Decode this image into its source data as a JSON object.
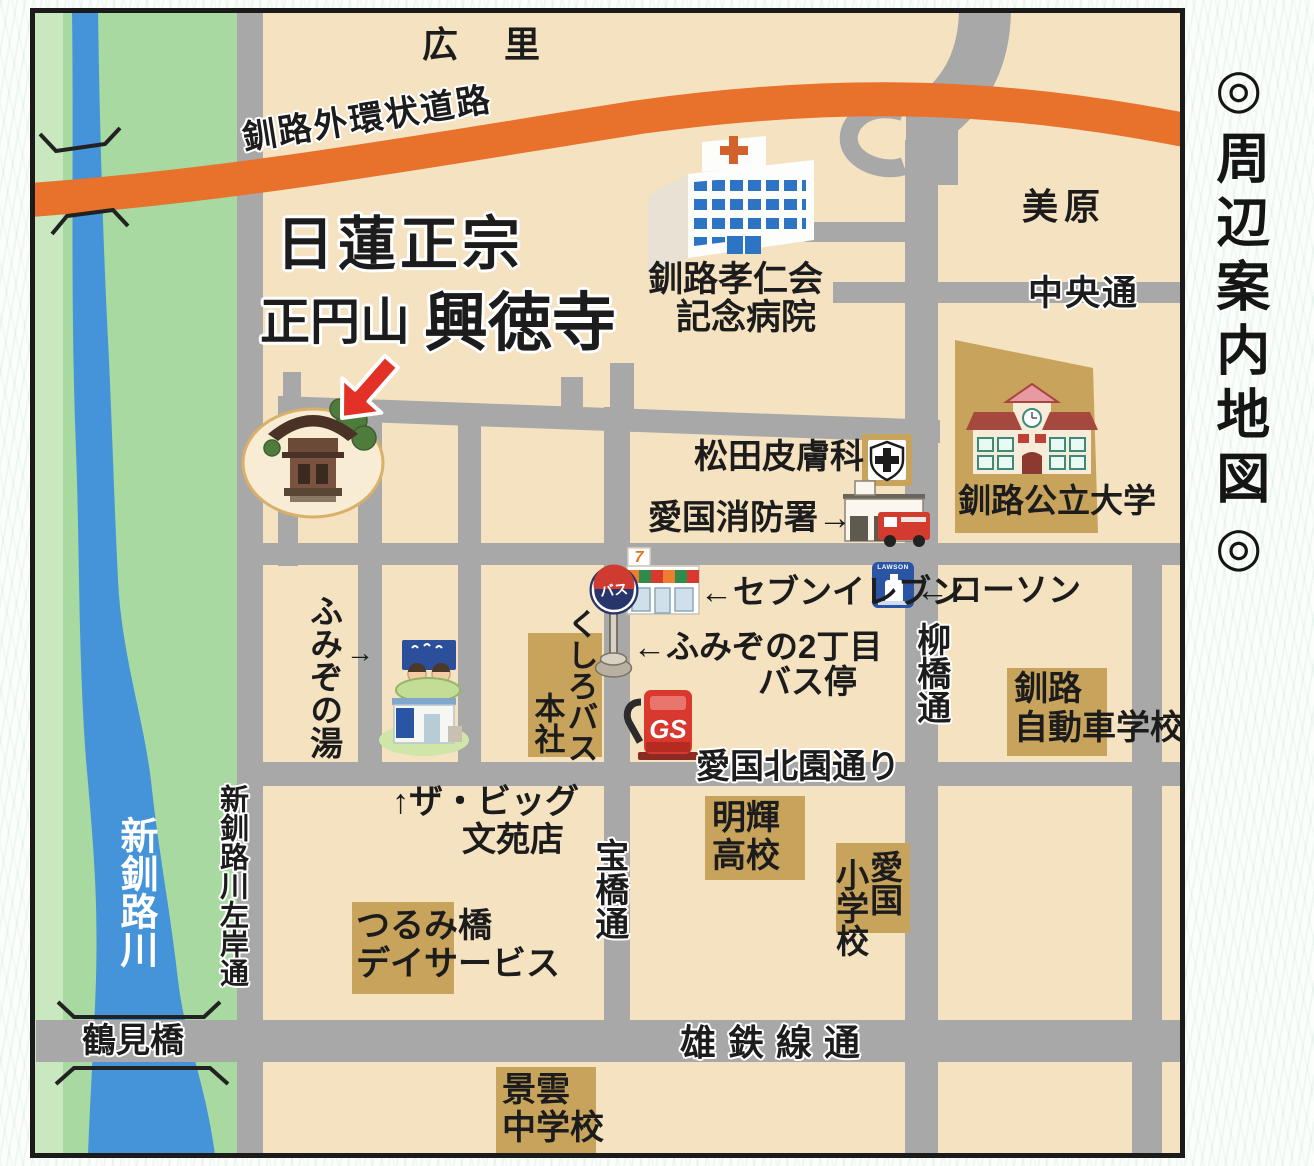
{
  "sidebar": {
    "title": "◎周辺案内地図◎"
  },
  "colors": {
    "land": "#f4e2c1",
    "greenbelt": "#a7d9a0",
    "river": "#4593d8",
    "road": "#a8a8a8",
    "expressway": "#e8712c",
    "block_tan": "#c8a35c",
    "arrow_red": "#e33128",
    "border": "#1b1b1b"
  },
  "map": {
    "areas": {
      "hirosato": "広 里",
      "mihara": "美原"
    },
    "title": {
      "sect": "日蓮正宗",
      "mountain": "正円山",
      "temple": "興徳寺"
    },
    "roads": {
      "expressway": "釧路外環状道路",
      "chuo": "中央通",
      "yanagibashi": "柳橋通",
      "takarabashi": "宝橋通",
      "kitazono": "愛国北園通り",
      "yutetsu": "雄鉄線通",
      "sagan": "新釧路川左岸通"
    },
    "river": {
      "name": "新釧路川",
      "bridge": "鶴見橋"
    },
    "places": {
      "hospital_l1": "釧路孝仁会",
      "hospital_l2": "記念病院",
      "university": "釧路公立大学",
      "matsuda": "松田皮膚科",
      "fire_station": "愛国消防署→",
      "seven": "←セブンイレブン",
      "lawson": "←ローソン",
      "bus_stop_l1": "←ふみぞの2丁目",
      "bus_stop_l2": "バス停",
      "kushiro_bus_l1": "くしろバス",
      "kushiro_bus_l2": "本社",
      "driving_l1": "釧路",
      "driving_l2": "自動車学校",
      "fumizono_yu": "ふみぞの湯",
      "fumizono_arrow": "→",
      "the_big_l1": "↑ザ・ビッグ",
      "the_big_l2": "文苑店",
      "meiki_l1": "明輝",
      "meiki_l2": "高校",
      "aikoku_col1": "愛国",
      "aikoku_col2": "小学校",
      "tsurumi_l1": "つるみ橋",
      "tsurumi_l2": "デイサービス",
      "keiun_l1": "景雲",
      "keiun_l2": "中学校"
    },
    "badges": {
      "gs": "GS",
      "bus": "バス",
      "seven_logo": "7",
      "lawson_sign": "LAWSON"
    }
  }
}
